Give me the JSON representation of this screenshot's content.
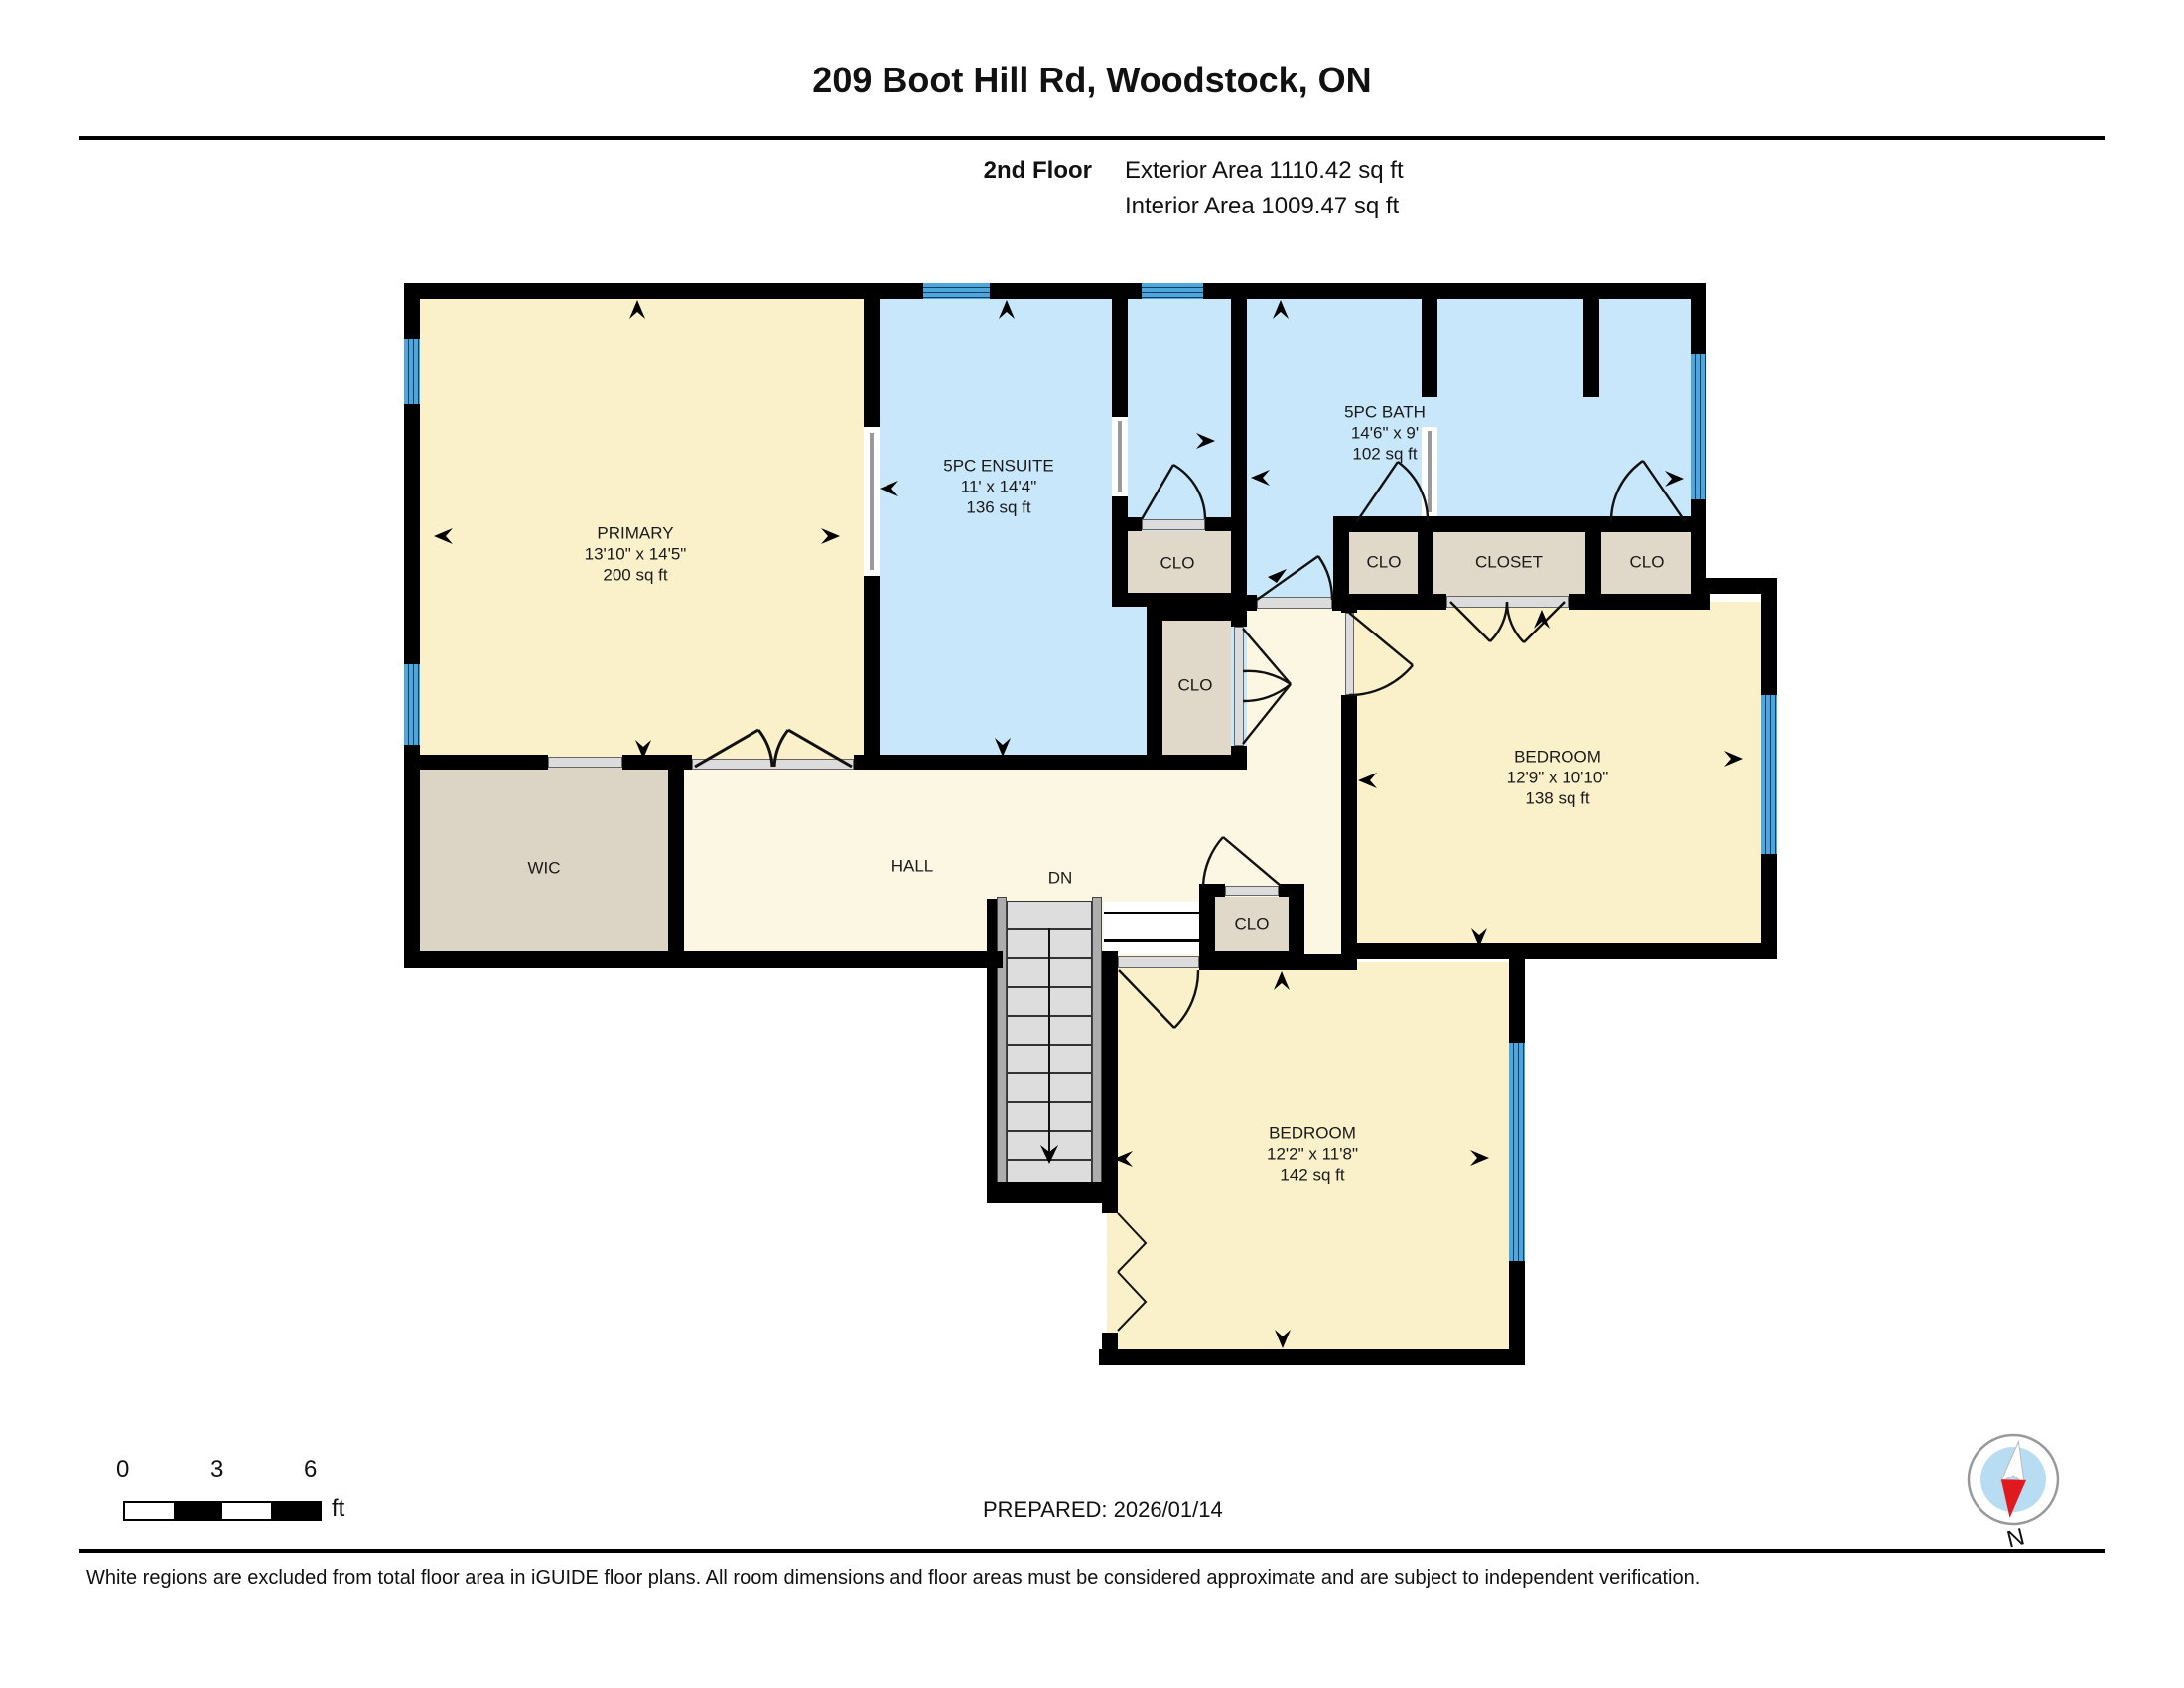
{
  "header": {
    "title": "209 Boot Hill Rd, Woodstock, ON",
    "floor_label": "2nd Floor",
    "exterior_area": "Exterior Area 1110.42 sq ft",
    "interior_area": "Interior Area 1009.47 sq ft"
  },
  "rooms": {
    "primary": {
      "name": "PRIMARY",
      "dims": "13'10\" x 14'5\"",
      "area": "200 sq ft"
    },
    "ensuite": {
      "name": "5PC ENSUITE",
      "dims": "11' x 14'4\"",
      "area": "136 sq ft"
    },
    "bath": {
      "name": "5PC BATH",
      "dims": "14'6\" x 9'",
      "area": "102 sq ft"
    },
    "bedroom_right": {
      "name": "BEDROOM",
      "dims": "12'9\" x 10'10\"",
      "area": "138 sq ft"
    },
    "bedroom_bottom": {
      "name": "BEDROOM",
      "dims": "12'2\" x 11'8\"",
      "area": "142 sq ft"
    },
    "wic": {
      "name": "WIC"
    },
    "hall": {
      "name": "HALL"
    },
    "stairs_dn": {
      "name": "DN"
    },
    "clo_mid1": {
      "name": "CLO"
    },
    "clo_mid2": {
      "name": "CLO"
    },
    "clo_left": {
      "name": "CLO"
    },
    "closet": {
      "name": "CLOSET"
    },
    "clo_right": {
      "name": "CLO"
    },
    "clo_stairs": {
      "name": "CLO"
    }
  },
  "scale": {
    "tick0": "0",
    "tick3": "3",
    "tick6": "6",
    "unit": "ft"
  },
  "footer": {
    "prepared": "PREPARED: 2026/01/14",
    "disclaimer": "White regions are excluded from total floor area in iGUIDE floor plans. All room dimensions and floor areas must be considered approximate and are subject to independent verification.",
    "compass_label": "N"
  },
  "colors": {
    "room_fill": "#FAF0CA",
    "hall_fill": "#FCF7E2",
    "wet_room_fill": "#C9E7FA",
    "closet_fill": "#E0D8C8",
    "window_blue": "#4FA6DC",
    "wall": "#000000",
    "compass_red": "#E0191F",
    "compass_inner": "#B8DCF2"
  }
}
